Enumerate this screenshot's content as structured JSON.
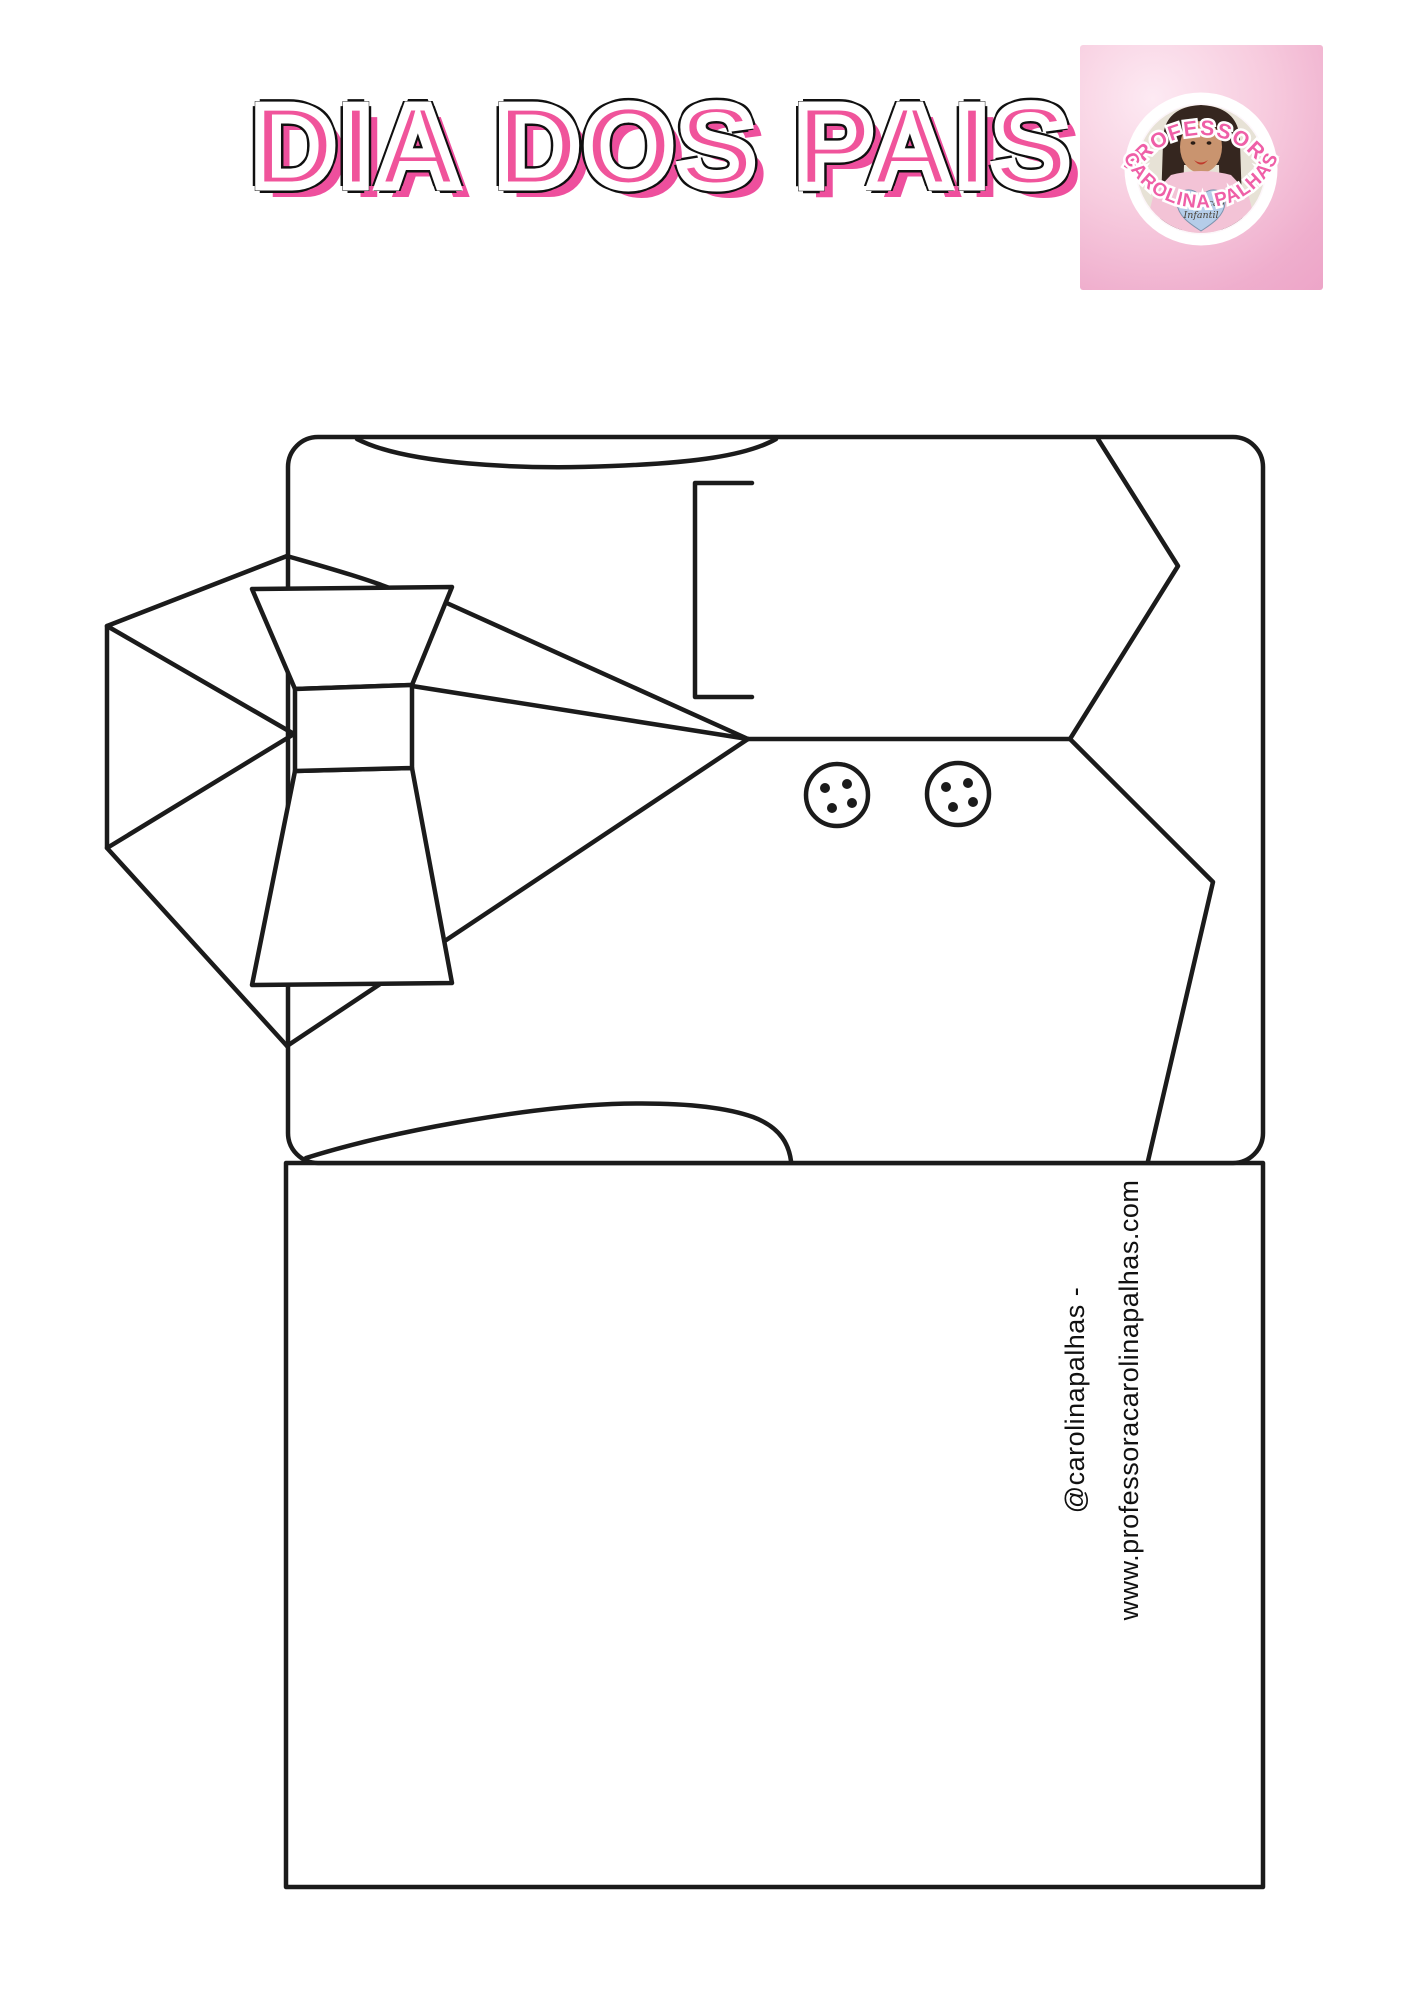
{
  "title": {
    "text": "DIA DOS PAIS"
  },
  "logo": {
    "arc_top": "PROFESSORA",
    "arc_bottom": "CAROLINA PALHAS",
    "shirt_heart_line1": "Educação",
    "shirt_heart_line2": "Infantil"
  },
  "watermark": {
    "line1": "@carolinapalhas -",
    "line2": "www.professoracarolinapalhas.com"
  },
  "colors": {
    "title-pink": "#f0549b",
    "title-pink-shadow": "#ee4f9d",
    "logo-pink": "#ef5fa7",
    "line": "#1b1b1b",
    "text": "#111111"
  }
}
